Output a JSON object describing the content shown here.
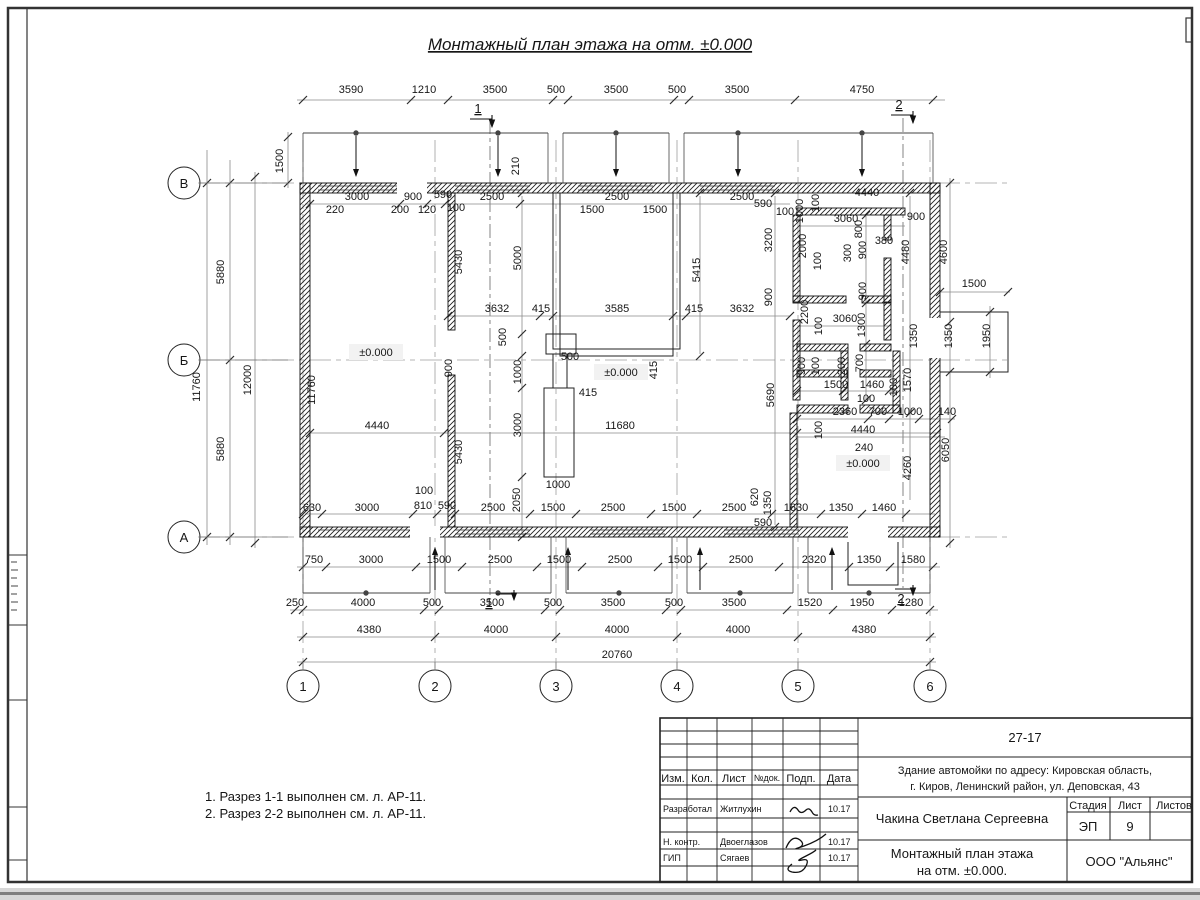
{
  "page": {
    "title": "Монтажный план этажа на отм. ±0.000"
  },
  "notes": [
    "1. Разрез 1-1 выполнен см. л. АР-11.",
    "2. Разрез 2-2 выполнен см. л. АР-11."
  ],
  "axes": {
    "rows": [
      "В",
      "Б",
      "А"
    ],
    "cols": [
      "1",
      "2",
      "3",
      "4",
      "5",
      "6"
    ]
  },
  "levels": [
    "±0.000",
    "±0.000",
    "±0.000"
  ],
  "section_marks": [
    "1",
    "2",
    "1",
    "2"
  ],
  "dims": [
    [
      "3590",
      351,
      93,
      0
    ],
    [
      "1210",
      424,
      93,
      0
    ],
    [
      "3500",
      495,
      93,
      0
    ],
    [
      "500",
      556,
      93,
      0
    ],
    [
      "3500",
      616,
      93,
      0
    ],
    [
      "500",
      677,
      93,
      0
    ],
    [
      "3500",
      737,
      93,
      0
    ],
    [
      "4750",
      862,
      93,
      0
    ],
    [
      "1500",
      283,
      161,
      1
    ],
    [
      "5880",
      224,
      272,
      1
    ],
    [
      "11760",
      200,
      387,
      1
    ],
    [
      "12000",
      251,
      380,
      1
    ],
    [
      "5880",
      224,
      449,
      1
    ],
    [
      "3000",
      357,
      200,
      0
    ],
    [
      "900",
      413,
      200,
      0
    ],
    [
      "590",
      443,
      198,
      0
    ],
    [
      "2500",
      492,
      200,
      0
    ],
    [
      "2500",
      617,
      200,
      0
    ],
    [
      "2500",
      742,
      200,
      0
    ],
    [
      "4440",
      867,
      196,
      0
    ],
    [
      "220",
      335,
      213,
      0
    ],
    [
      "200",
      400,
      213,
      0
    ],
    [
      "120",
      427,
      213,
      0
    ],
    [
      "100",
      456,
      211,
      0
    ],
    [
      "1500",
      592,
      213,
      0
    ],
    [
      "1500",
      655,
      213,
      0
    ],
    [
      "590",
      763,
      207,
      0
    ],
    [
      "100",
      785,
      215,
      0
    ],
    [
      "210",
      519,
      166,
      1
    ],
    [
      "1000",
      803,
      211,
      1
    ],
    [
      "100",
      819,
      203,
      1
    ],
    [
      "11760",
      315,
      390,
      1
    ],
    [
      "5430",
      462,
      262,
      1
    ],
    [
      "5430",
      462,
      452,
      1
    ],
    [
      "5000",
      521,
      258,
      1
    ],
    [
      "3200",
      772,
      240,
      1
    ],
    [
      "900",
      772,
      297,
      1
    ],
    [
      "2000",
      806,
      246,
      1
    ],
    [
      "100",
      821,
      261,
      1
    ],
    [
      "800",
      862,
      229,
      1
    ],
    [
      "300",
      851,
      253,
      1
    ],
    [
      "900",
      866,
      250,
      1
    ],
    [
      "380",
      884,
      244,
      0
    ],
    [
      "900",
      916,
      220,
      0
    ],
    [
      "3060",
      846,
      222,
      0
    ],
    [
      "4480",
      909,
      252,
      1
    ],
    [
      "4600",
      947,
      252,
      1
    ],
    [
      "3632",
      497,
      312,
      0
    ],
    [
      "415",
      541,
      312,
      0
    ],
    [
      "3585",
      617,
      312,
      0
    ],
    [
      "415",
      694,
      312,
      0
    ],
    [
      "3632",
      742,
      312,
      0
    ],
    [
      "5415",
      700,
      270,
      1
    ],
    [
      "500",
      506,
      337,
      1
    ],
    [
      "500",
      570,
      360,
      0
    ],
    [
      "900",
      452,
      368,
      1
    ],
    [
      "1000",
      521,
      372,
      1
    ],
    [
      "415",
      588,
      396,
      0
    ],
    [
      "415",
      657,
      370,
      1
    ],
    [
      "3000",
      521,
      425,
      1
    ],
    [
      "1000",
      558,
      488,
      0
    ],
    [
      "2050",
      520,
      500,
      1
    ],
    [
      "2200",
      808,
      312,
      1
    ],
    [
      "3060",
      845,
      322,
      0
    ],
    [
      "1300",
      865,
      325,
      1
    ],
    [
      "100",
      822,
      326,
      1
    ],
    [
      "900",
      866,
      291,
      1
    ],
    [
      "1500",
      974,
      287,
      0
    ],
    [
      "1350",
      917,
      336,
      1
    ],
    [
      "1350",
      952,
      336,
      1
    ],
    [
      "1950",
      990,
      336,
      1
    ],
    [
      "5690",
      774,
      395,
      1
    ],
    [
      "900",
      805,
      366,
      1
    ],
    [
      "100",
      819,
      366,
      1
    ],
    [
      "200",
      845,
      366,
      1
    ],
    [
      "700",
      863,
      363,
      1
    ],
    [
      "1500",
      836,
      388,
      0
    ],
    [
      "1460",
      872,
      388,
      0
    ],
    [
      "100",
      866,
      402,
      0
    ],
    [
      "100",
      897,
      387,
      1
    ],
    [
      "1570",
      911,
      380,
      1
    ],
    [
      "2360",
      845,
      415,
      0
    ],
    [
      "700",
      878,
      415,
      0
    ],
    [
      "1000",
      910,
      415,
      0
    ],
    [
      "140",
      947,
      415,
      0
    ],
    [
      "100",
      822,
      430,
      1
    ],
    [
      "4440",
      863,
      433,
      0
    ],
    [
      "240",
      864,
      451,
      0
    ],
    [
      "4440",
      377,
      429,
      0
    ],
    [
      "11680",
      620,
      429,
      0
    ],
    [
      "4260",
      911,
      468,
      1
    ],
    [
      "6050",
      949,
      450,
      1
    ],
    [
      "620",
      758,
      497,
      1
    ],
    [
      "1350",
      771,
      503,
      1
    ],
    [
      "590",
      763,
      526,
      0
    ],
    [
      "630",
      312,
      511,
      0
    ],
    [
      "3000",
      367,
      511,
      0
    ],
    [
      "810",
      423,
      509,
      0
    ],
    [
      "590",
      447,
      509,
      0
    ],
    [
      "2500",
      493,
      511,
      0
    ],
    [
      "1500",
      553,
      511,
      0
    ],
    [
      "2500",
      613,
      511,
      0
    ],
    [
      "1500",
      674,
      511,
      0
    ],
    [
      "2500",
      734,
      511,
      0
    ],
    [
      "1630",
      796,
      511,
      0
    ],
    [
      "1350",
      841,
      511,
      0
    ],
    [
      "1460",
      884,
      511,
      0
    ],
    [
      "100",
      424,
      494,
      0
    ],
    [
      "750",
      314,
      563,
      0
    ],
    [
      "3000",
      371,
      563,
      0
    ],
    [
      "1500",
      439,
      563,
      0
    ],
    [
      "2500",
      500,
      563,
      0
    ],
    [
      "1500",
      559,
      563,
      0
    ],
    [
      "2500",
      620,
      563,
      0
    ],
    [
      "1500",
      680,
      563,
      0
    ],
    [
      "2500",
      741,
      563,
      0
    ],
    [
      "2320",
      814,
      563,
      0
    ],
    [
      "1350",
      869,
      563,
      0
    ],
    [
      "1580",
      913,
      563,
      0
    ],
    [
      "250",
      295,
      606,
      0
    ],
    [
      "4000",
      363,
      606,
      0
    ],
    [
      "500",
      432,
      606,
      0
    ],
    [
      "3500",
      492,
      606,
      0
    ],
    [
      "500",
      553,
      606,
      0
    ],
    [
      "3500",
      613,
      606,
      0
    ],
    [
      "500",
      674,
      606,
      0
    ],
    [
      "3500",
      734,
      606,
      0
    ],
    [
      "1520",
      810,
      606,
      0
    ],
    [
      "1950",
      862,
      606,
      0
    ],
    [
      "1280",
      911,
      606,
      0
    ],
    [
      "4380",
      369,
      633,
      0
    ],
    [
      "4000",
      496,
      633,
      0
    ],
    [
      "4000",
      617,
      633,
      0
    ],
    [
      "4000",
      738,
      633,
      0
    ],
    [
      "4380",
      864,
      633,
      0
    ],
    [
      "20760",
      617,
      658,
      0
    ]
  ],
  "title_block": {
    "doc_no": "27-17",
    "object_line1": "Здание автомойки по адресу: Кировская область,",
    "object_line2": "г. Киров, Ленинский район, ул. Деповская, 43",
    "cols": [
      "Изм.",
      "Кол.",
      "Лист",
      "№док.",
      "Подп.",
      "Дата"
    ],
    "rows": [
      {
        "role": "Разработал",
        "name": "Житлухин",
        "date": "10.17"
      },
      {
        "role": "Н. контр.",
        "name": "Двоеглазов",
        "date": "10.17"
      },
      {
        "role": "ГИП",
        "name": "Сягаев",
        "date": "10.17"
      }
    ],
    "author": "Чакина Светлана Сергеевна",
    "sheet_title_line1": "Монтажный план этажа",
    "sheet_title_line2": "на отм. ±0.000.",
    "stage_label": "Стадия",
    "sheet_label": "Лист",
    "sheets_label": "Листов",
    "stage": "ЭП",
    "sheet_no": "9",
    "company": "ООО \"Альянс\""
  }
}
